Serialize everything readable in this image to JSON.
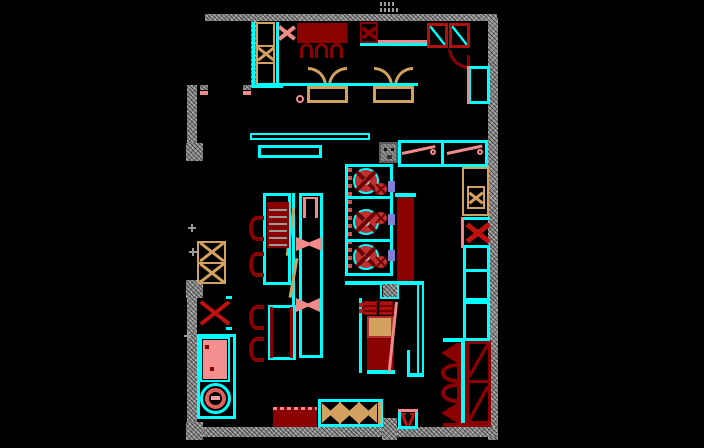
{
  "drawing": {
    "type": "cad-floor-plan",
    "subject": "restaurant-kitchen-and-dining-floor-plan",
    "visible_text": "none-legible (tiny gray level annotation near top wall)",
    "elements": [
      "hatched-perimeter-walls",
      "entry-opening-left",
      "entry-door-right-with-swing-arc",
      "dining-booths-tan",
      "dining-tables-darkred",
      "x-marked-cabinets",
      "pass-shelves-cyan",
      "sink-counter-with-drainboards",
      "cook-line-with-burners",
      "range-darkred",
      "fryer-station",
      "prep-tables",
      "two-basin-sink",
      "round-equipment",
      "benches-bottom",
      "booth-bank-bottom-right",
      "floor-drain-box",
      "wall-columns"
    ]
  },
  "palette": {
    "bg": "#000000",
    "wall": "#8c8c8c",
    "wallDark": "#5a5a5a",
    "cyan": "#00ffff",
    "darkred": "#8b0000",
    "red": "#c01010",
    "tan": "#d2a05f",
    "salmon": "#f08a8a",
    "pink": "#f48f8f",
    "purple": "#7f7fd6",
    "grayline": "#9a9a9a"
  }
}
